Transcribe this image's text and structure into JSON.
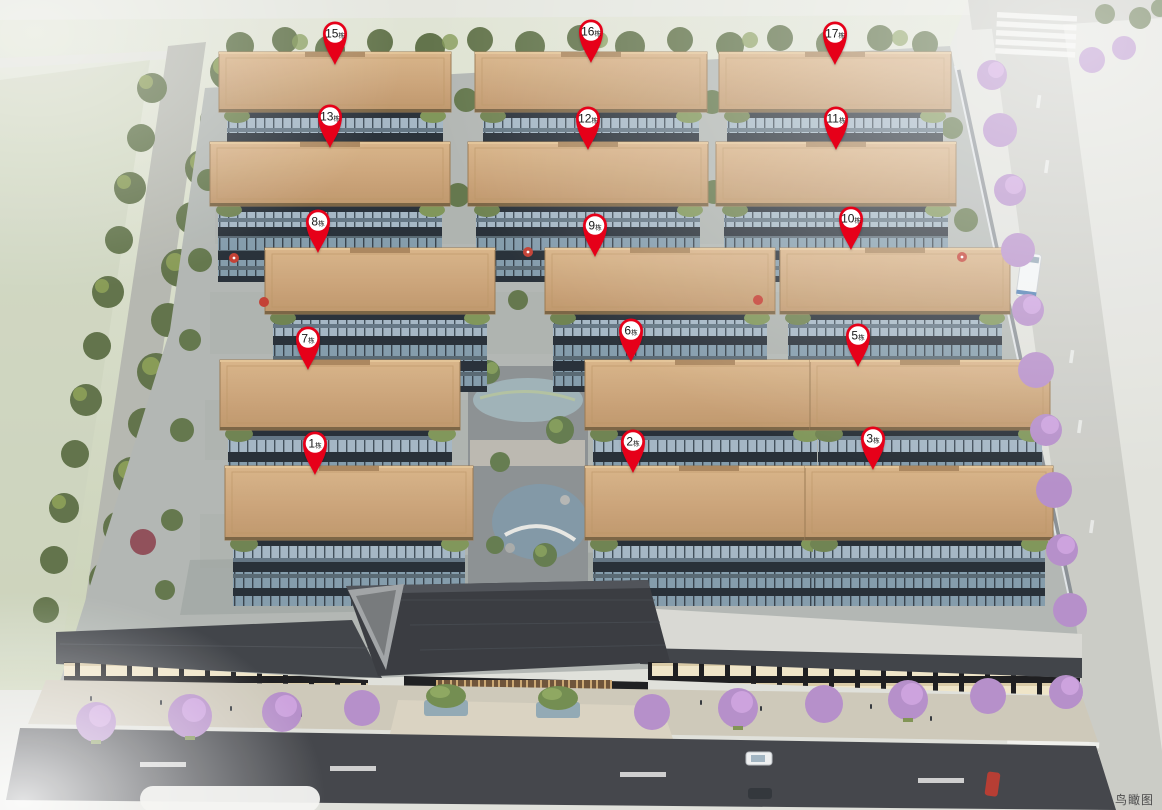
{
  "page": {
    "watermark": "鸟瞰图"
  },
  "pins": {
    "color": "#e60019",
    "text_color": "#1a1a1a",
    "unit_suffix": "栋",
    "items": [
      {
        "label": "15",
        "x": 335,
        "y": 65
      },
      {
        "label": "16",
        "x": 591,
        "y": 63
      },
      {
        "label": "17",
        "x": 835,
        "y": 65
      },
      {
        "label": "13",
        "x": 330,
        "y": 148
      },
      {
        "label": "12",
        "x": 588,
        "y": 150
      },
      {
        "label": "11",
        "x": 836,
        "y": 150
      },
      {
        "label": "8",
        "x": 318,
        "y": 253
      },
      {
        "label": "9",
        "x": 595,
        "y": 257
      },
      {
        "label": "10",
        "x": 851,
        "y": 250
      },
      {
        "label": "7",
        "x": 308,
        "y": 370
      },
      {
        "label": "6",
        "x": 631,
        "y": 362
      },
      {
        "label": "5",
        "x": 858,
        "y": 367
      },
      {
        "label": "1",
        "x": 315,
        "y": 475
      },
      {
        "label": "2",
        "x": 633,
        "y": 473
      },
      {
        "label": "3",
        "x": 873,
        "y": 470
      }
    ]
  }
}
